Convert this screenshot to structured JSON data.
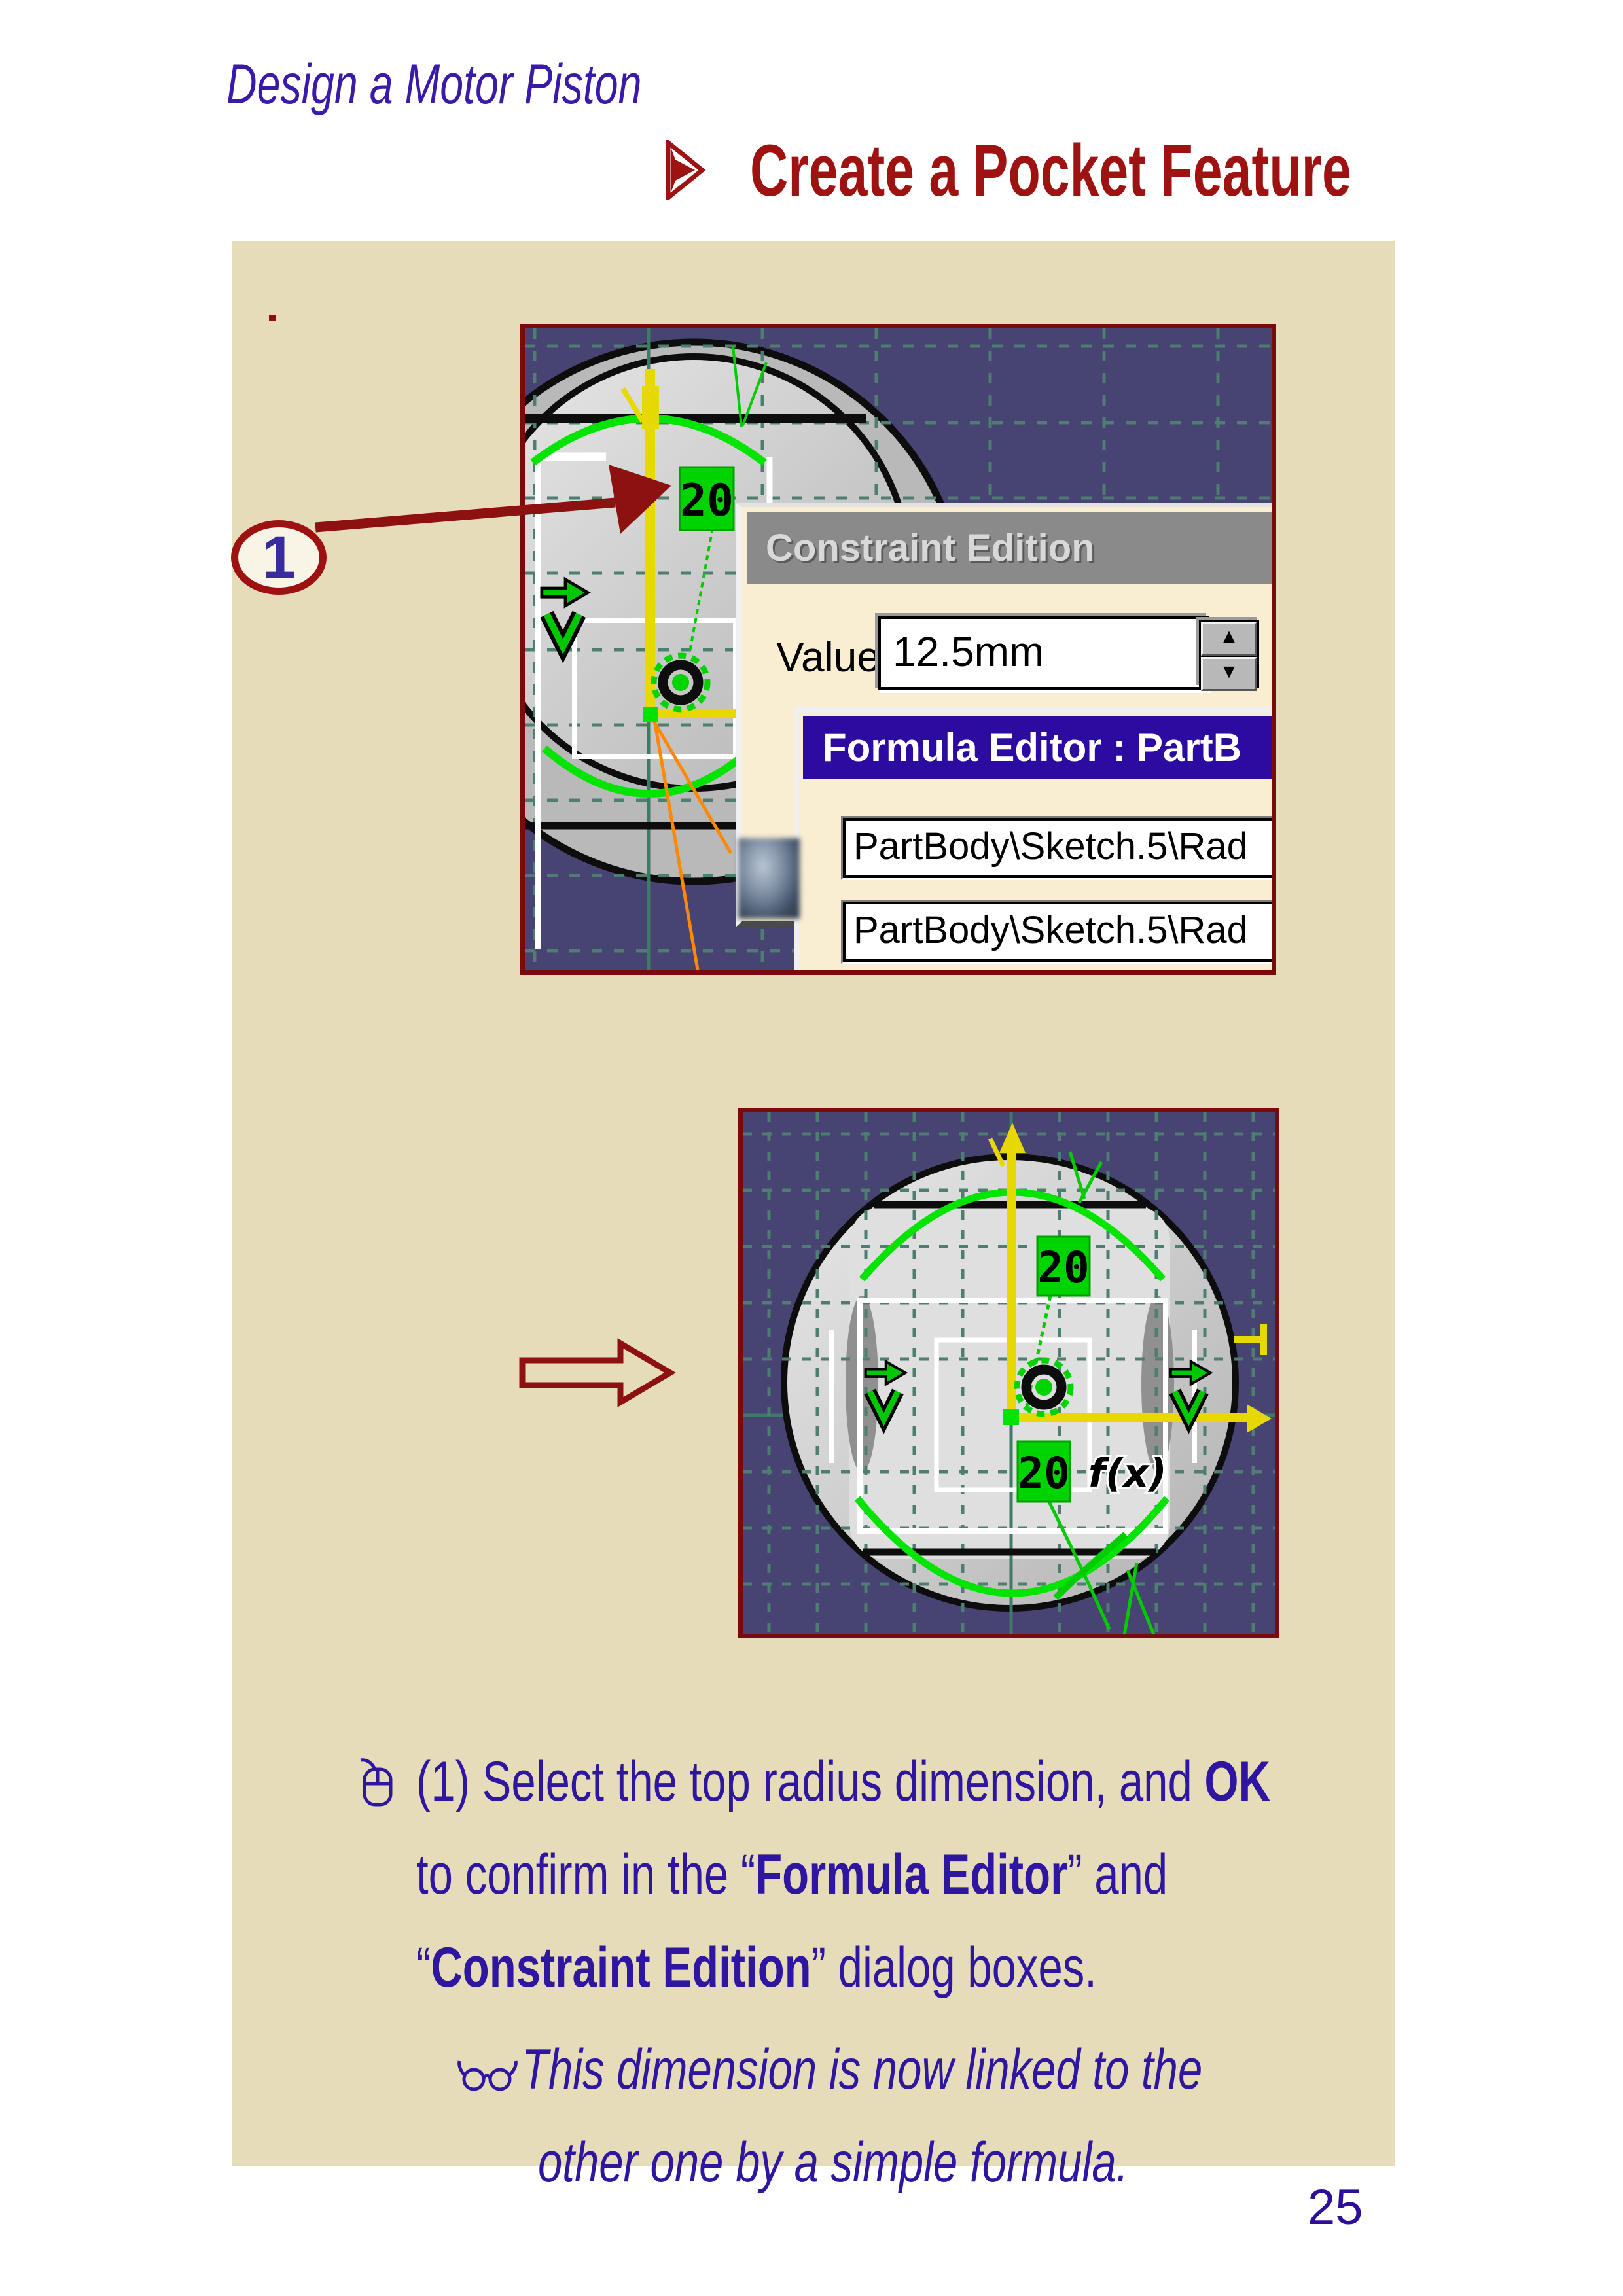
{
  "page": {
    "title": "Design a Motor Piston",
    "heading": "Create a Pocket Feature",
    "page_number": "25",
    "step_marker": "1"
  },
  "colors": {
    "accent_red": "#9e1212",
    "border_red": "#7a0b0b",
    "panel_beige": "#e6dcba",
    "dialog_cream": "#f9edd2",
    "cad_background": "#474372",
    "grid_teal": "#4e7d72",
    "highlight_green": "#00d400",
    "dimension_yellow": "#e6d800",
    "text_indigo": "#2e16a0",
    "formula_title_navy": "#2b0ba0"
  },
  "icons": {
    "bullet": "arrow-bullet-icon",
    "step_line": "mouse-icon",
    "note_line": "glasses-icon",
    "transition": "hollow-arrow-icon",
    "callout": "red-arrow-icon"
  },
  "cad1": {
    "radius_dim": "20"
  },
  "cad2": {
    "radius_dim_top": "20",
    "radius_dim_bottom": "20",
    "formula_flag": "f(x)"
  },
  "constraint_dialog": {
    "title": "Constraint Edition",
    "value_label": "Value",
    "value": "12.5mm"
  },
  "formula_dialog": {
    "title": "Formula Editor : PartB",
    "field1": "PartBody\\Sketch.5\\Rad",
    "field2": "PartBody\\Sketch.5\\Rad"
  },
  "body": {
    "line1_pre": "(1) Select the top radius dimension, and ",
    "line1_bold": "OK",
    "line2_pre": "to confirm in the “",
    "line2_bold": "Formula Editor",
    "line2_post": "” and",
    "line3_pre": "“",
    "line3_bold": "Constraint Edition",
    "line3_post": "” dialog boxes.",
    "note1": "This dimension is now linked to the",
    "note2": "other one by a simple formula."
  }
}
